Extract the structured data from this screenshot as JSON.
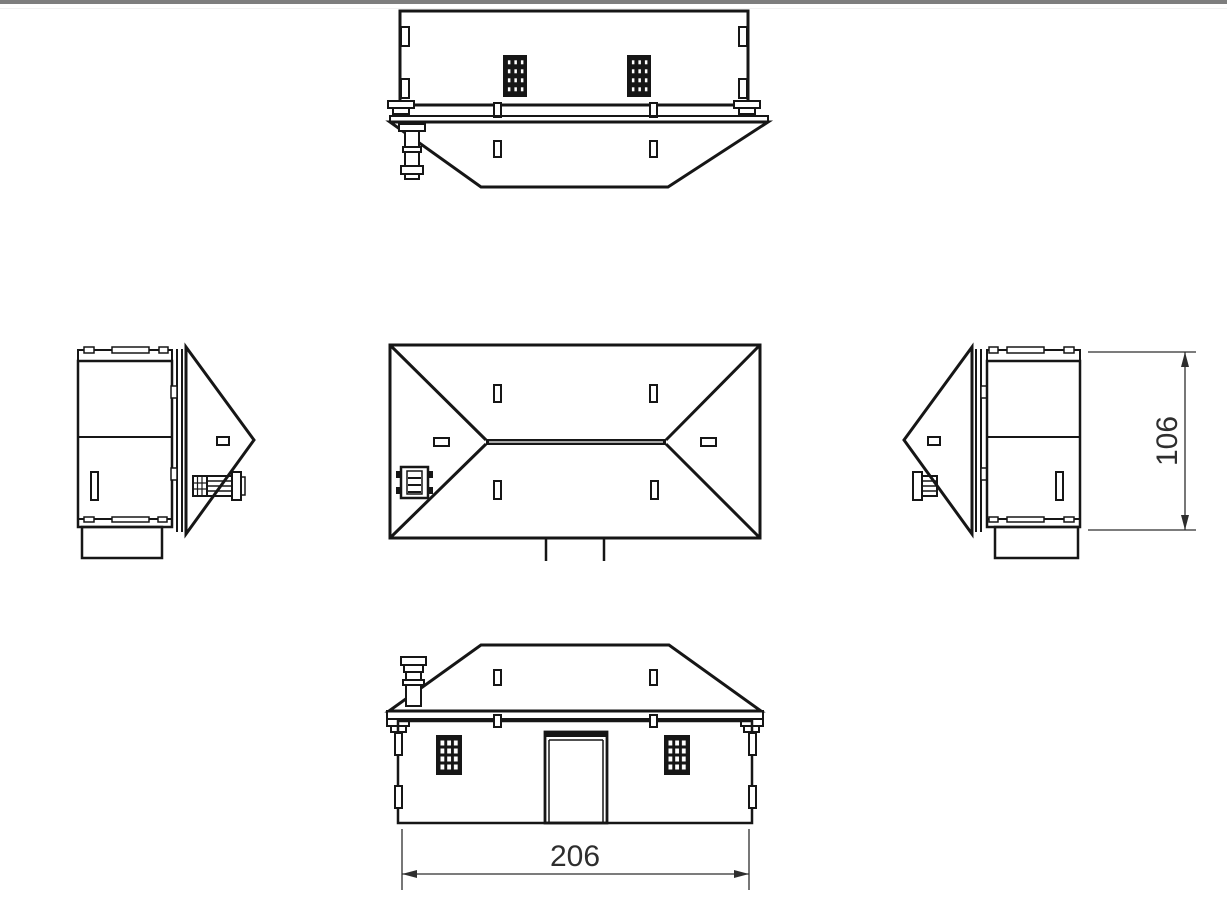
{
  "colors": {
    "background": "#ffffff",
    "line": "#161616",
    "dimension": "#2e2e2e",
    "top_border": "#7e7e7e"
  },
  "dimensions": {
    "width_label": "206",
    "height_label": "106"
  }
}
